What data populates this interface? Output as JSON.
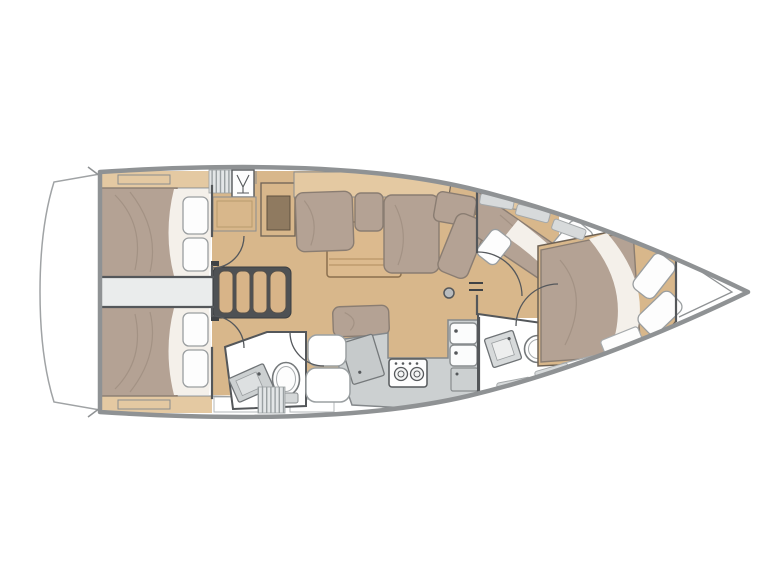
{
  "title": "Sailing yacht interior layout floor plan (top view, bow to the right)",
  "orientation": {
    "bow": "right",
    "stern": "left",
    "top_side": "port",
    "bottom_side": "starboard"
  },
  "colors": {
    "hull_outline": "#8f9294",
    "wall": "#54575a",
    "deck_white": "#ffffff",
    "wood_floor": "#d8b78b",
    "wood_shelf": "#e4c9a2",
    "wood_dark": "#8f7a60",
    "mattress": "#b4a294",
    "cushion_edge": "#8a7d72",
    "pillow": "#fdfdfd",
    "pillow_edge": "#9a9ea0",
    "sheet_white": "#f4f0ea",
    "counter": "#ccd0d1",
    "fixture_edge": "#75797b",
    "corridor": "#eaecec",
    "hatch_bg": "#e3e6e7",
    "hatch_line": "#9aa0a2",
    "window": "#d7dadb",
    "window_edge": "#a4a8aa",
    "steps_wood": "#d8b488",
    "steps_frame": "#4e5154",
    "table_wood": "#dcba8e",
    "table_edge": "#8a6f4e"
  },
  "inventory": {
    "aft_double_cabins": 2,
    "aft_cabin_pillows_each": 2,
    "companionway_steps": 4,
    "nav_desk": 1,
    "salon": {
      "l_shaped_sofa": 1,
      "chaise_lounge": 1,
      "dinette_table": 1,
      "bench_seat": 1,
      "mast_post": 1
    },
    "heads": 2,
    "toilets": 2,
    "bathroom_sinks": 2,
    "galley": {
      "stove_burners": 2,
      "sink_basins": 2,
      "icebox_lid": 1
    },
    "forward_cabin": {
      "double_bed": 1,
      "angled_side_berth": 1,
      "pillows": 4
    },
    "pillows_total": 8,
    "deck_hatches": 2
  }
}
